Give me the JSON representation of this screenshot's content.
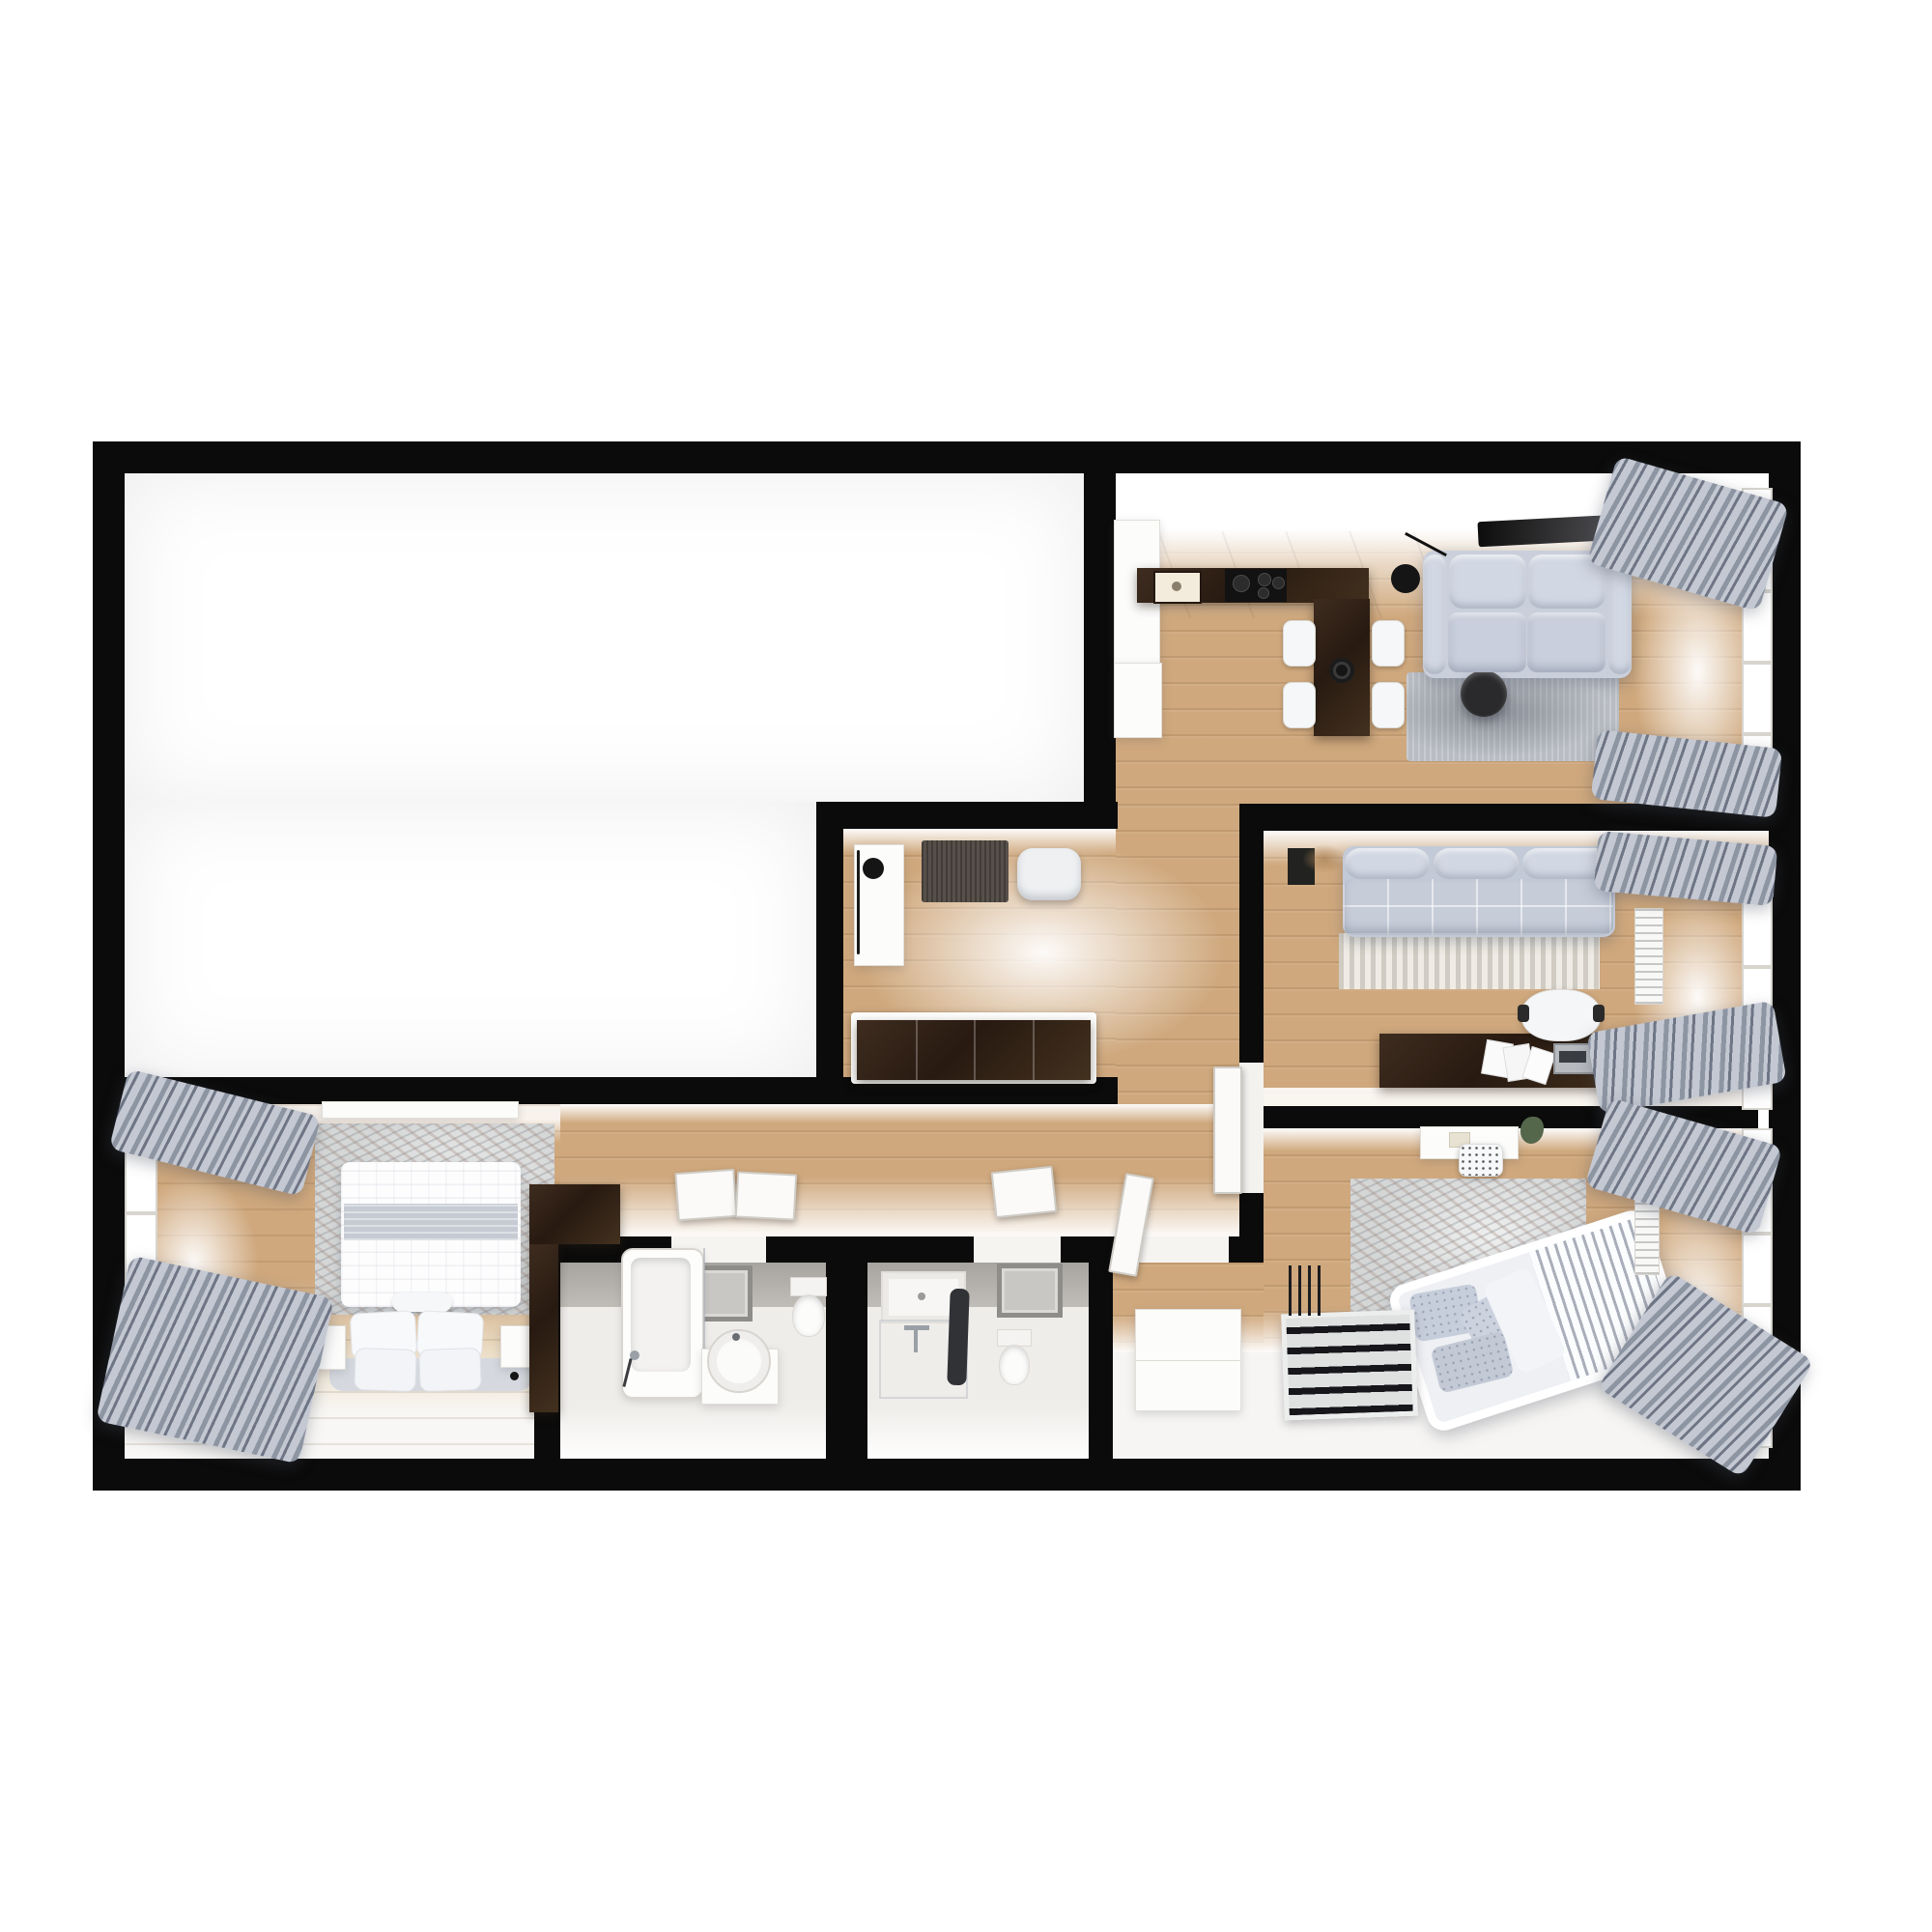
{
  "scene": {
    "title": "3D top-down apartment floor plan render",
    "style": "photoreal architectural dollhouse view",
    "background": "#ffffff",
    "no_visible_text": true
  },
  "colors": {
    "wall": "#0b0b0b",
    "wood": "#cfa87d",
    "woodDeep": "#c29a6d",
    "wenge": "#31221a",
    "sofa": "#ccd2de",
    "sofaShade": "#aeb6c6",
    "curtainA": "#8d95a3",
    "curtainB": "#c3c8d2",
    "curtainC": "#6e7585",
    "rugStripeA": "#d0ccc3",
    "rugStripeB": "#efece5",
    "tileFloor": "#efedea",
    "tileWall": "#b3b0ac",
    "plant": "#55674a",
    "doormat": "#57504a",
    "windowFrame": "#d8d5cf"
  },
  "rooms": [
    {
      "id": "empty-room",
      "label": "unfurnished white room (top-left)",
      "furniture": []
    },
    {
      "id": "living-kitchen",
      "label": "open kitchen / living / dining (top-right)",
      "furniture": [
        "kitchen-counter",
        "kitchen-sink",
        "cooktop",
        "fridge-column",
        "lower-cabinet",
        "dining-peninsula",
        "fruit-bowl",
        "dining-chair x4",
        "sofa-two-seater",
        "floor-lamp",
        "coffee-table",
        "rug",
        "tv-panel",
        "window",
        "curtains"
      ]
    },
    {
      "id": "lounge",
      "label": "second living room (middle-right)",
      "furniture": [
        "modular-sofa",
        "plant-box",
        "striped-rug",
        "desk",
        "papers",
        "laptop",
        "mouse",
        "office-chair",
        "radiator",
        "window",
        "curtains",
        "open-door"
      ]
    },
    {
      "id": "nursery",
      "label": "child bedroom (bottom-right)",
      "furniture": [
        "kids-desk",
        "kids-chair",
        "plant",
        "distressed-rug",
        "crib",
        "toy-ladder",
        "dresser",
        "radiator",
        "window",
        "curtains",
        "open-door"
      ]
    },
    {
      "id": "entrance-hall",
      "label": "entrance hall (center)",
      "furniture": [
        "console",
        "vase",
        "doormat",
        "pouf",
        "wardrobe"
      ]
    },
    {
      "id": "corridor",
      "label": "L-shaped corridor (center)",
      "furniture": [
        "open-door x3"
      ]
    },
    {
      "id": "bedroom",
      "label": "master bedroom (bottom-left)",
      "furniture": [
        "double-bed",
        "pillows x4",
        "bolster",
        "nightstand x2",
        "wall-lamp x2",
        "distressed-rug",
        "wardrobe",
        "closet-band",
        "window",
        "curtains"
      ]
    },
    {
      "id": "bathroom-1",
      "label": "bathroom with tub (bottom-center-left)",
      "furniture": [
        "bathtub",
        "shower-screen",
        "round-washbasin",
        "vanity-cabinet",
        "toilet",
        "wall-mirror"
      ]
    },
    {
      "id": "bathroom-2",
      "label": "shower bathroom (bottom-center-right)",
      "furniture": [
        "shower-tray",
        "shower-screen",
        "faucet",
        "towel-rail",
        "toilet",
        "wall-mirror"
      ]
    }
  ]
}
